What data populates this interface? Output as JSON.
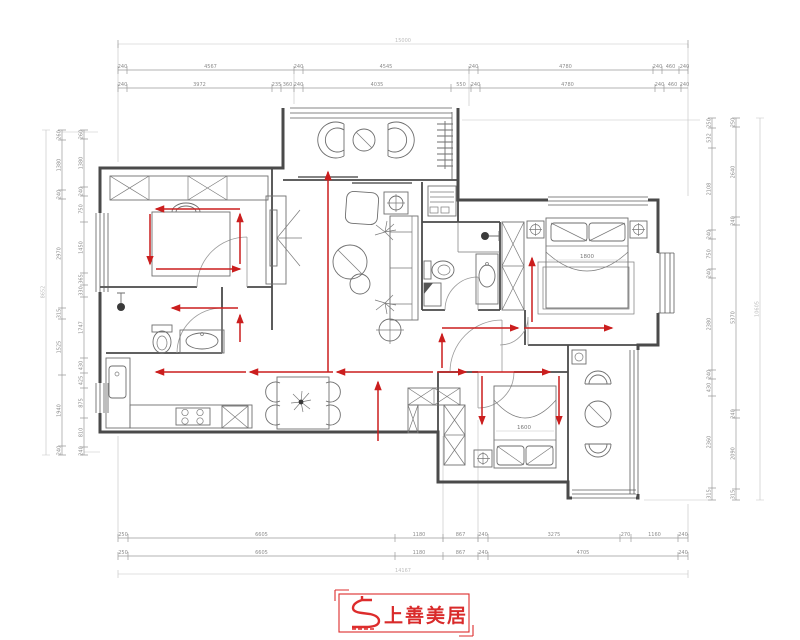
{
  "logo": {
    "brand": "上善美居"
  },
  "labels": {
    "master_bed": "1800",
    "second_bed": "1600"
  },
  "dims": {
    "top_total": "15000",
    "top_row1": [
      "240",
      "4567",
      "240",
      "4545",
      "240",
      "4780",
      "240",
      "460",
      "240"
    ],
    "top_row2": [
      "240",
      "3972",
      "235",
      "360",
      "240",
      "4035",
      "550",
      "240",
      "4780",
      "240",
      "460",
      "240"
    ],
    "bottom_row1": [
      "250",
      "6605",
      "1180",
      "867",
      "240",
      "3275",
      "270",
      "1160",
      "240"
    ],
    "bottom_row2": [
      "250",
      "6605",
      "1180",
      "867",
      "240",
      "4705",
      "240"
    ],
    "bottom_total": "14167",
    "left_total": "8652",
    "left_outer": [
      "260",
      "1380",
      "240",
      "2970",
      "315",
      "1525",
      "1940",
      "240"
    ],
    "left_inner": [
      "260",
      "1380",
      "240",
      "750",
      "1450",
      "365",
      "330",
      "1747",
      "430",
      "425",
      "875",
      "810",
      "240"
    ],
    "right_total": "10605",
    "right_inner": [
      "250",
      "532",
      "2108",
      "240",
      "750",
      "240",
      "2380",
      "240",
      "430",
      "2360",
      "315"
    ],
    "right_mid": [
      "250",
      "2640",
      "240",
      "5370",
      "240",
      "2090",
      "315"
    ]
  },
  "colors": {
    "arrow": "#cb1e1e",
    "wall": "#4a4a4a",
    "dim_text": "#8c8c8c",
    "logo": "#dd2c2c"
  }
}
